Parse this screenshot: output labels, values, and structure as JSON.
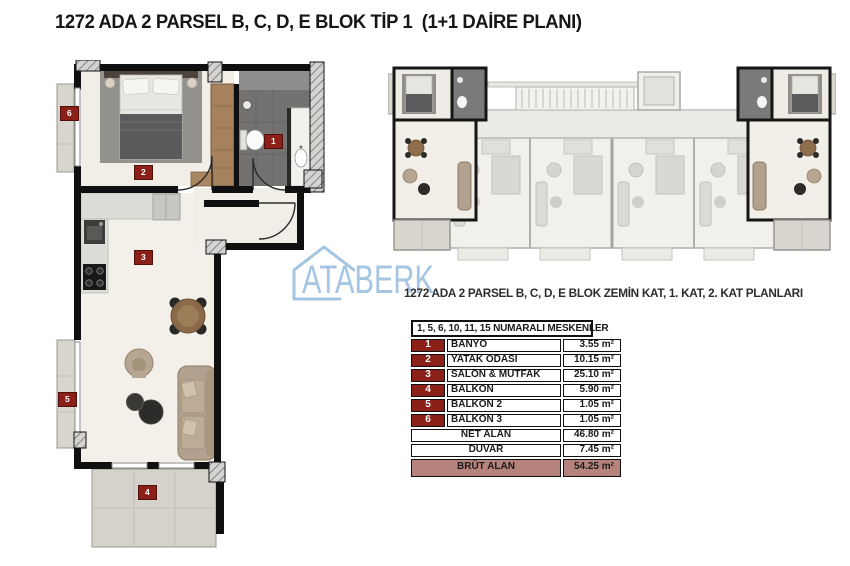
{
  "title": "1272 ADA 2 PARSEL B, C, D, E BLOK TİP 1  (1+1 DAİRE PLANI)",
  "caption": "1272 ADA 2 PARSEL B, C, D, E BLOK ZEMİN KAT, 1. KAT, 2. KAT PLANLARI",
  "logo": {
    "text": "ATABERK"
  },
  "plan": {
    "markers": [
      "1",
      "2",
      "3",
      "4",
      "5",
      "6"
    ]
  },
  "table": {
    "header": "1, 5, 6, 10, 11, 15 NUMARALI MESKENLER",
    "rows": [
      {
        "no": "1",
        "name": "BANYO",
        "area": "3.55 m²"
      },
      {
        "no": "2",
        "name": "YATAK ODASI",
        "area": "10.15 m²"
      },
      {
        "no": "3",
        "name": "SALON & MUTFAK",
        "area": "25.10 m²"
      },
      {
        "no": "4",
        "name": "BALKON",
        "area": "5.90 m²"
      },
      {
        "no": "5",
        "name": "BALKON 2",
        "area": "1.05 m²"
      },
      {
        "no": "6",
        "name": "BALKON 3",
        "area": "1.05 m²"
      }
    ],
    "summary": [
      {
        "name": "NET ALAN",
        "area": "46.80 m²"
      },
      {
        "name": "DUVAR",
        "area": "7.45 m²"
      },
      {
        "name": "BRÜT ALAN",
        "area": "54.25 m²"
      }
    ]
  },
  "colors": {
    "marker_red": "#8a2017",
    "brut_bg": "#b5837b",
    "logo_blue": "#a5c6e3"
  }
}
